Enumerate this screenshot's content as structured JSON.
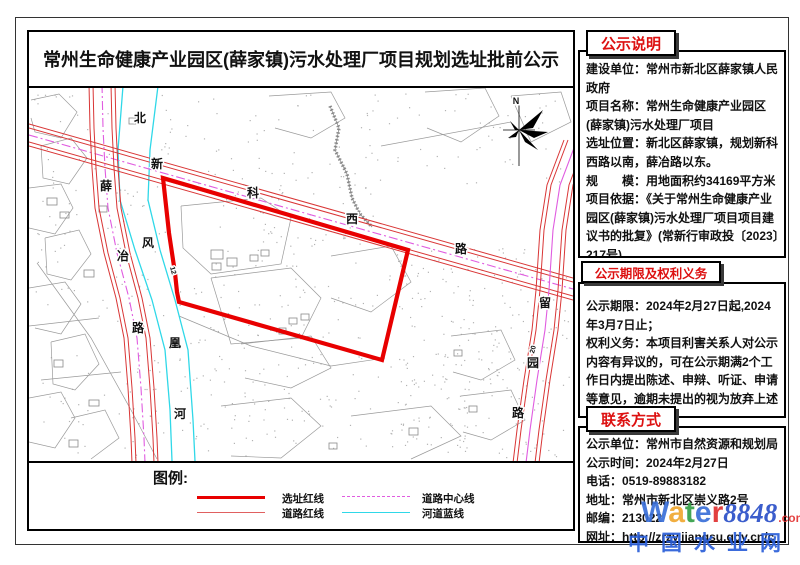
{
  "title": "常州生命健康产业园区(薛家镇)污水处理厂项目规划选址批前公示",
  "panels": [
    {
      "header": "公示说明",
      "items": [
        "建设单位：常州市新北区薛家镇人民政府",
        "项目名称：常州生命健康产业园区(薛家镇)污水处理厂项目",
        "选址位置：新北区薛家镇，规划新科西路以南，薛冶路以东。",
        "规　　模：用地面积约34169平方米",
        "项目依据：《关于常州生命健康产业园区(薛家镇)污水处理厂项目项目建议书的批复》(常新行审政投〔2023〕217号)。"
      ]
    },
    {
      "header": "公示期限及权利义务",
      "items": [
        "公示期限：2024年2月27日起,2024年3月7日止；",
        "权利义务：本项目利害关系人对公示内容有异议的，可在公示期满2个工作日内提出陈述、申辩、听证、申请等意见，逾期未提出的视为放弃上述权利。"
      ]
    },
    {
      "header": "联系方式",
      "items": [
        "公示单位：常州市自然资源和规划局",
        "公示时间：2024年2月27日",
        "电话：0519-89883182",
        "地址：常州市新北区崇义路2号",
        "邮编：213022",
        "网址：http://zrzy.jiangsu.gov.cn/cz/"
      ]
    }
  ],
  "legend": {
    "title": "图例:",
    "items": [
      {
        "label": "选址红线",
        "kind": "thick-red"
      },
      {
        "label": "道路红线",
        "kind": "thin-red"
      },
      {
        "label": "道路中心线",
        "kind": "magenta-dash"
      },
      {
        "label": "河道蓝线",
        "kind": "cyan"
      }
    ]
  },
  "watermark": {
    "letters": [
      [
        "W",
        "#3a6fd8"
      ],
      [
        "a",
        "#f0a830"
      ],
      [
        "t",
        "#35a048"
      ],
      [
        "e",
        "#3a6fd8"
      ],
      [
        "r",
        "#e03030"
      ]
    ],
    "number": "8848",
    "number_color": "#2b50c8",
    "dotcom": ".com",
    "dotcom_color": "#e23333",
    "cn": "中国水业网",
    "cn_color": "#2b5fd9"
  },
  "colors": {
    "site_red": "#e80000",
    "road_red": "#d93636",
    "center_magenta": "#e05ce0",
    "river_cyan": "#2fd8e8",
    "parcel_gray": "#9a9a9a",
    "dot_gray": "#b3b3b3"
  },
  "map": {
    "site_polygon": [
      [
        134,
        90
      ],
      [
        379,
        162
      ],
      [
        353,
        272
      ],
      [
        150,
        214
      ],
      [
        148,
        204
      ],
      [
        146,
        185
      ],
      [
        140,
        145
      ]
    ],
    "roads": [
      {
        "name": "xinke-west-road",
        "axis": "y",
        "half": 11,
        "inner": 7,
        "center_style": "dashdot",
        "center": [
          [
            0,
            47
          ],
          [
            544,
            201
          ]
        ]
      },
      {
        "name": "xueye-road",
        "axis": "x",
        "half": 13,
        "inner": 9,
        "center_style": "dashdot",
        "center": [
          [
            73,
            -4
          ],
          [
            74,
            40
          ],
          [
            76,
            80
          ],
          [
            79,
            120
          ],
          [
            88,
            165
          ],
          [
            100,
            210
          ],
          [
            108,
            250
          ],
          [
            112,
            300
          ],
          [
            115,
            350
          ],
          [
            116,
            375
          ]
        ]
      },
      {
        "name": "liuyuan-road",
        "axis": "x",
        "half": 13,
        "inner": 9,
        "center_style": "solid",
        "center": [
          [
            548,
            52
          ],
          [
            531,
            97
          ],
          [
            524,
            142
          ],
          [
            520,
            202
          ],
          [
            516,
            242
          ],
          [
            508,
            292
          ],
          [
            501,
            342
          ],
          [
            497,
            375
          ]
        ]
      }
    ],
    "river": [
      [
        [
          94,
          -2
        ],
        [
          89,
          62
        ],
        [
          91,
          112
        ],
        [
          106,
          162
        ],
        [
          123,
          212
        ],
        [
          136,
          262
        ],
        [
          141,
          322
        ],
        [
          143,
          373
        ]
      ],
      [
        [
          129,
          -2
        ],
        [
          121,
          62
        ],
        [
          119,
          112
        ],
        [
          131,
          162
        ],
        [
          146,
          212
        ],
        [
          159,
          262
        ],
        [
          164,
          332
        ],
        [
          166,
          373
        ]
      ]
    ],
    "stream": [
      [
        301,
        18
      ],
      [
        310,
        40
      ],
      [
        306,
        62
      ],
      [
        318,
        86
      ],
      [
        323,
        110
      ],
      [
        331,
        126
      ],
      [
        343,
        139
      ]
    ],
    "parcels": [
      [
        [
          2,
          12
        ],
        [
          30,
          6
        ],
        [
          48,
          24
        ],
        [
          32,
          50
        ],
        [
          6,
          44
        ],
        [
          2,
          30
        ]
      ],
      [
        [
          12,
          58
        ],
        [
          42,
          50
        ],
        [
          58,
          70
        ],
        [
          40,
          96
        ],
        [
          14,
          90
        ],
        [
          12,
          58
        ]
      ],
      [
        [
          0,
          100
        ],
        [
          32,
          96
        ],
        [
          44,
          120
        ],
        [
          26,
          146
        ],
        [
          0,
          140
        ]
      ],
      [
        [
          16,
          150
        ],
        [
          50,
          142
        ],
        [
          62,
          166
        ],
        [
          42,
          192
        ],
        [
          18,
          186
        ],
        [
          16,
          150
        ]
      ],
      [
        [
          0,
          200
        ],
        [
          36,
          194
        ],
        [
          52,
          216
        ],
        [
          32,
          246
        ],
        [
          6,
          240
        ]
      ],
      [
        [
          22,
          254
        ],
        [
          56,
          246
        ],
        [
          70,
          276
        ],
        [
          46,
          302
        ],
        [
          24,
          296
        ],
        [
          22,
          254
        ]
      ],
      [
        [
          0,
          310
        ],
        [
          32,
          304
        ],
        [
          46,
          330
        ],
        [
          26,
          360
        ],
        [
          0,
          354
        ]
      ],
      [
        [
          42,
          330
        ],
        [
          76,
          322
        ],
        [
          90,
          350
        ],
        [
          62,
          371
        ]
      ],
      [
        [
          8,
          175
        ],
        [
          62,
          250
        ],
        [
          102,
          322
        ],
        [
          128,
          371
        ]
      ],
      [
        [
          0,
          238
        ],
        [
          70,
          230
        ]
      ],
      [
        [
          12,
          292
        ],
        [
          92,
          284
        ]
      ],
      [
        [
          152,
          118
        ],
        [
          232,
          110
        ],
        [
          262,
          130
        ],
        [
          252,
          176
        ],
        [
          182,
          186
        ],
        [
          154,
          160
        ],
        [
          152,
          118
        ]
      ],
      [
        [
          182,
          190
        ],
        [
          262,
          180
        ],
        [
          292,
          210
        ],
        [
          272,
          250
        ],
        [
          202,
          256
        ],
        [
          182,
          190
        ]
      ],
      [
        [
          212,
          256
        ],
        [
          282,
          248
        ],
        [
          302,
          280
        ],
        [
          262,
          300
        ],
        [
          216,
          290
        ]
      ],
      [
        [
          302,
          168
        ],
        [
          362,
          158
        ],
        [
          382,
          194
        ],
        [
          342,
          224
        ],
        [
          302,
          210
        ]
      ],
      [
        [
          150,
          228
        ],
        [
          222,
          258
        ],
        [
          302,
          278
        ],
        [
          356,
          270
        ]
      ],
      [
        [
          192,
          318
        ],
        [
          262,
          310
        ],
        [
          292,
          338
        ],
        [
          252,
          370
        ],
        [
          202,
          368
        ]
      ],
      [
        [
          322,
          328
        ],
        [
          402,
          318
        ],
        [
          432,
          348
        ],
        [
          382,
          371
        ]
      ],
      [
        [
          240,
          8
        ],
        [
          302,
          4
        ],
        [
          316,
          30
        ],
        [
          282,
          50
        ],
        [
          246,
          40
        ]
      ],
      [
        [
          396,
          4
        ],
        [
          456,
          0
        ],
        [
          470,
          28
        ],
        [
          432,
          54
        ],
        [
          398,
          40
        ]
      ],
      [
        [
          482,
          8
        ],
        [
          532,
          4
        ],
        [
          542,
          34
        ],
        [
          502,
          54
        ],
        [
          482,
          8
        ]
      ],
      [
        [
          352,
          58
        ],
        [
          482,
          34
        ]
      ],
      [
        [
          422,
          248
        ],
        [
          472,
          242
        ],
        [
          486,
          272
        ],
        [
          452,
          292
        ],
        [
          424,
          284
        ]
      ],
      [
        [
          432,
          308
        ],
        [
          482,
          302
        ],
        [
          496,
          332
        ],
        [
          462,
          352
        ],
        [
          434,
          344
        ]
      ]
    ],
    "buildings": [
      [
        182,
        162,
        12,
        9
      ],
      [
        198,
        170,
        10,
        8
      ],
      [
        183,
        175,
        9,
        7
      ],
      [
        221,
        167,
        8,
        6
      ],
      [
        232,
        162,
        8,
        6
      ],
      [
        260,
        230,
        8,
        6
      ],
      [
        272,
        226,
        8,
        6
      ],
      [
        250,
        240,
        7,
        6
      ],
      [
        18,
        110,
        10,
        7
      ],
      [
        31,
        124,
        9,
        6
      ],
      [
        55,
        182,
        10,
        7
      ],
      [
        25,
        272,
        9,
        7
      ],
      [
        60,
        312,
        10,
        6
      ],
      [
        70,
        118,
        8,
        6
      ],
      [
        40,
        352,
        9,
        7
      ],
      [
        100,
        30,
        8,
        6
      ],
      [
        425,
        262,
        8,
        6
      ],
      [
        440,
        318,
        8,
        6
      ],
      [
        380,
        340,
        9,
        7
      ],
      [
        300,
        355,
        8,
        6
      ]
    ],
    "dot_regions": [
      {
        "x": 360,
        "y": 160,
        "w": 180,
        "h": 210,
        "n": 260,
        "seed": 11
      },
      {
        "x": 150,
        "y": 195,
        "w": 200,
        "h": 175,
        "n": 150,
        "seed": 22
      },
      {
        "x": 120,
        "y": 5,
        "w": 260,
        "h": 95,
        "n": 80,
        "seed": 33
      },
      {
        "x": 385,
        "y": 5,
        "w": 150,
        "h": 90,
        "n": 40,
        "seed": 44
      },
      {
        "x": 85,
        "y": 95,
        "w": 55,
        "h": 275,
        "n": 60,
        "seed": 55
      },
      {
        "x": 5,
        "y": 5,
        "w": 75,
        "h": 360,
        "n": 70,
        "seed": 66
      },
      {
        "x": 185,
        "y": 100,
        "w": 160,
        "h": 95,
        "n": 60,
        "seed": 77
      }
    ],
    "labels": [
      {
        "ch": "北",
        "x": 111,
        "y": 34,
        "s": 12
      },
      {
        "ch": "新",
        "x": 128,
        "y": 80,
        "s": 12
      },
      {
        "ch": "科",
        "x": 224,
        "y": 109,
        "s": 12
      },
      {
        "ch": "西",
        "x": 323,
        "y": 135,
        "s": 12
      },
      {
        "ch": "路",
        "x": 432,
        "y": 165,
        "s": 12
      },
      {
        "ch": "薛",
        "x": 77,
        "y": 102,
        "s": 12
      },
      {
        "ch": "冶",
        "x": 94,
        "y": 172,
        "s": 12
      },
      {
        "ch": "路",
        "x": 109,
        "y": 244,
        "s": 12
      },
      {
        "ch": "风",
        "x": 119,
        "y": 159,
        "s": 12
      },
      {
        "ch": "凰",
        "x": 146,
        "y": 259,
        "s": 12
      },
      {
        "ch": "河",
        "x": 151,
        "y": 330,
        "s": 12
      },
      {
        "ch": "留",
        "x": 516,
        "y": 219,
        "s": 12
      },
      {
        "ch": "园",
        "x": 504,
        "y": 279,
        "s": 12
      },
      {
        "ch": "路",
        "x": 489,
        "y": 329,
        "s": 12
      },
      {
        "ch": "N",
        "x": 487,
        "y": 16,
        "s": 9
      },
      {
        "ch": "20",
        "x": 506,
        "y": 262,
        "s": 7,
        "rot": -75
      },
      {
        "ch": "12",
        "x": 142,
        "y": 183,
        "s": 7,
        "rot": 75
      }
    ],
    "north_arrow": {
      "line_v": [
        [
          490,
          8
        ],
        [
          490,
          78
        ]
      ],
      "line_h": [
        [
          474,
          42
        ],
        [
          506,
          42
        ]
      ],
      "wedges": [
        [
          [
            490,
            42
          ],
          [
            514,
            22
          ],
          [
            504,
            40
          ]
        ],
        [
          [
            490,
            42
          ],
          [
            519,
            44
          ],
          [
            505,
            50
          ]
        ],
        [
          [
            490,
            42
          ],
          [
            509,
            62
          ],
          [
            496,
            54
          ]
        ],
        [
          [
            490,
            42
          ],
          [
            481,
            33
          ],
          [
            486,
            42
          ]
        ],
        [
          [
            490,
            42
          ],
          [
            479,
            50
          ],
          [
            487,
            49
          ]
        ]
      ]
    }
  }
}
